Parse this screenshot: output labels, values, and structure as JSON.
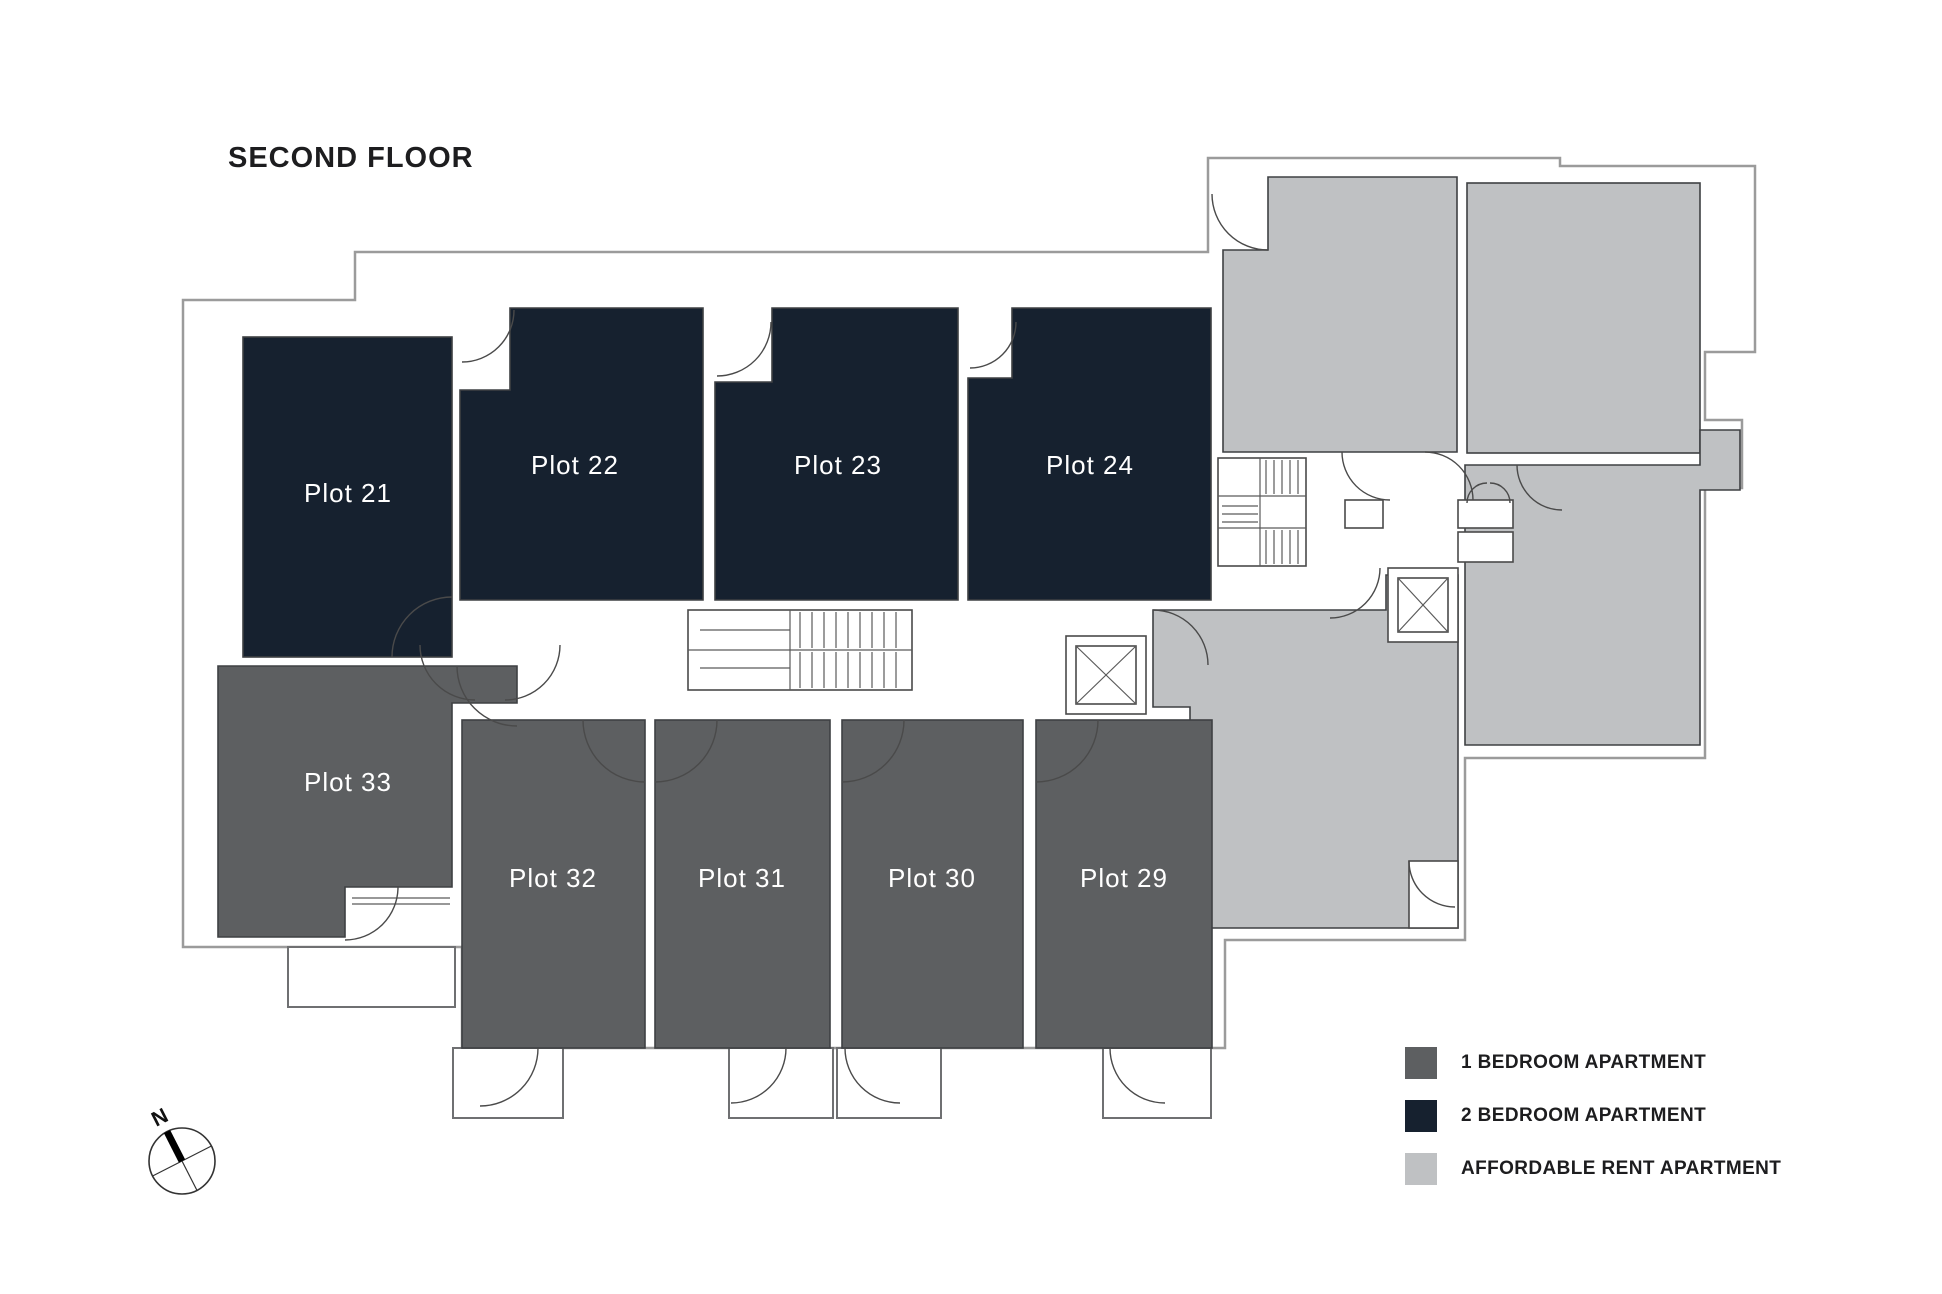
{
  "title": "SECOND FLOOR",
  "compass": {
    "north_label": "N"
  },
  "colors": {
    "one_bed": "#5d5f61",
    "two_bed": "#16212f",
    "affordable": "#bfc1c3",
    "wall": "#9b9b9b"
  },
  "rooms": {
    "two_bed": [
      {
        "label": "Plot 21"
      },
      {
        "label": "Plot 22"
      },
      {
        "label": "Plot 23"
      },
      {
        "label": "Plot 24"
      }
    ],
    "one_bed": [
      {
        "label": "Plot 29"
      },
      {
        "label": "Plot 30"
      },
      {
        "label": "Plot 31"
      },
      {
        "label": "Plot 32"
      },
      {
        "label": "Plot 33"
      }
    ]
  },
  "legend": {
    "items": [
      {
        "label": "1 BEDROOM APARTMENT",
        "color": "#5d5f61"
      },
      {
        "label": "2 BEDROOM APARTMENT",
        "color": "#16212f"
      },
      {
        "label": "AFFORDABLE RENT APARTMENT",
        "color": "#bfc1c3"
      }
    ]
  }
}
